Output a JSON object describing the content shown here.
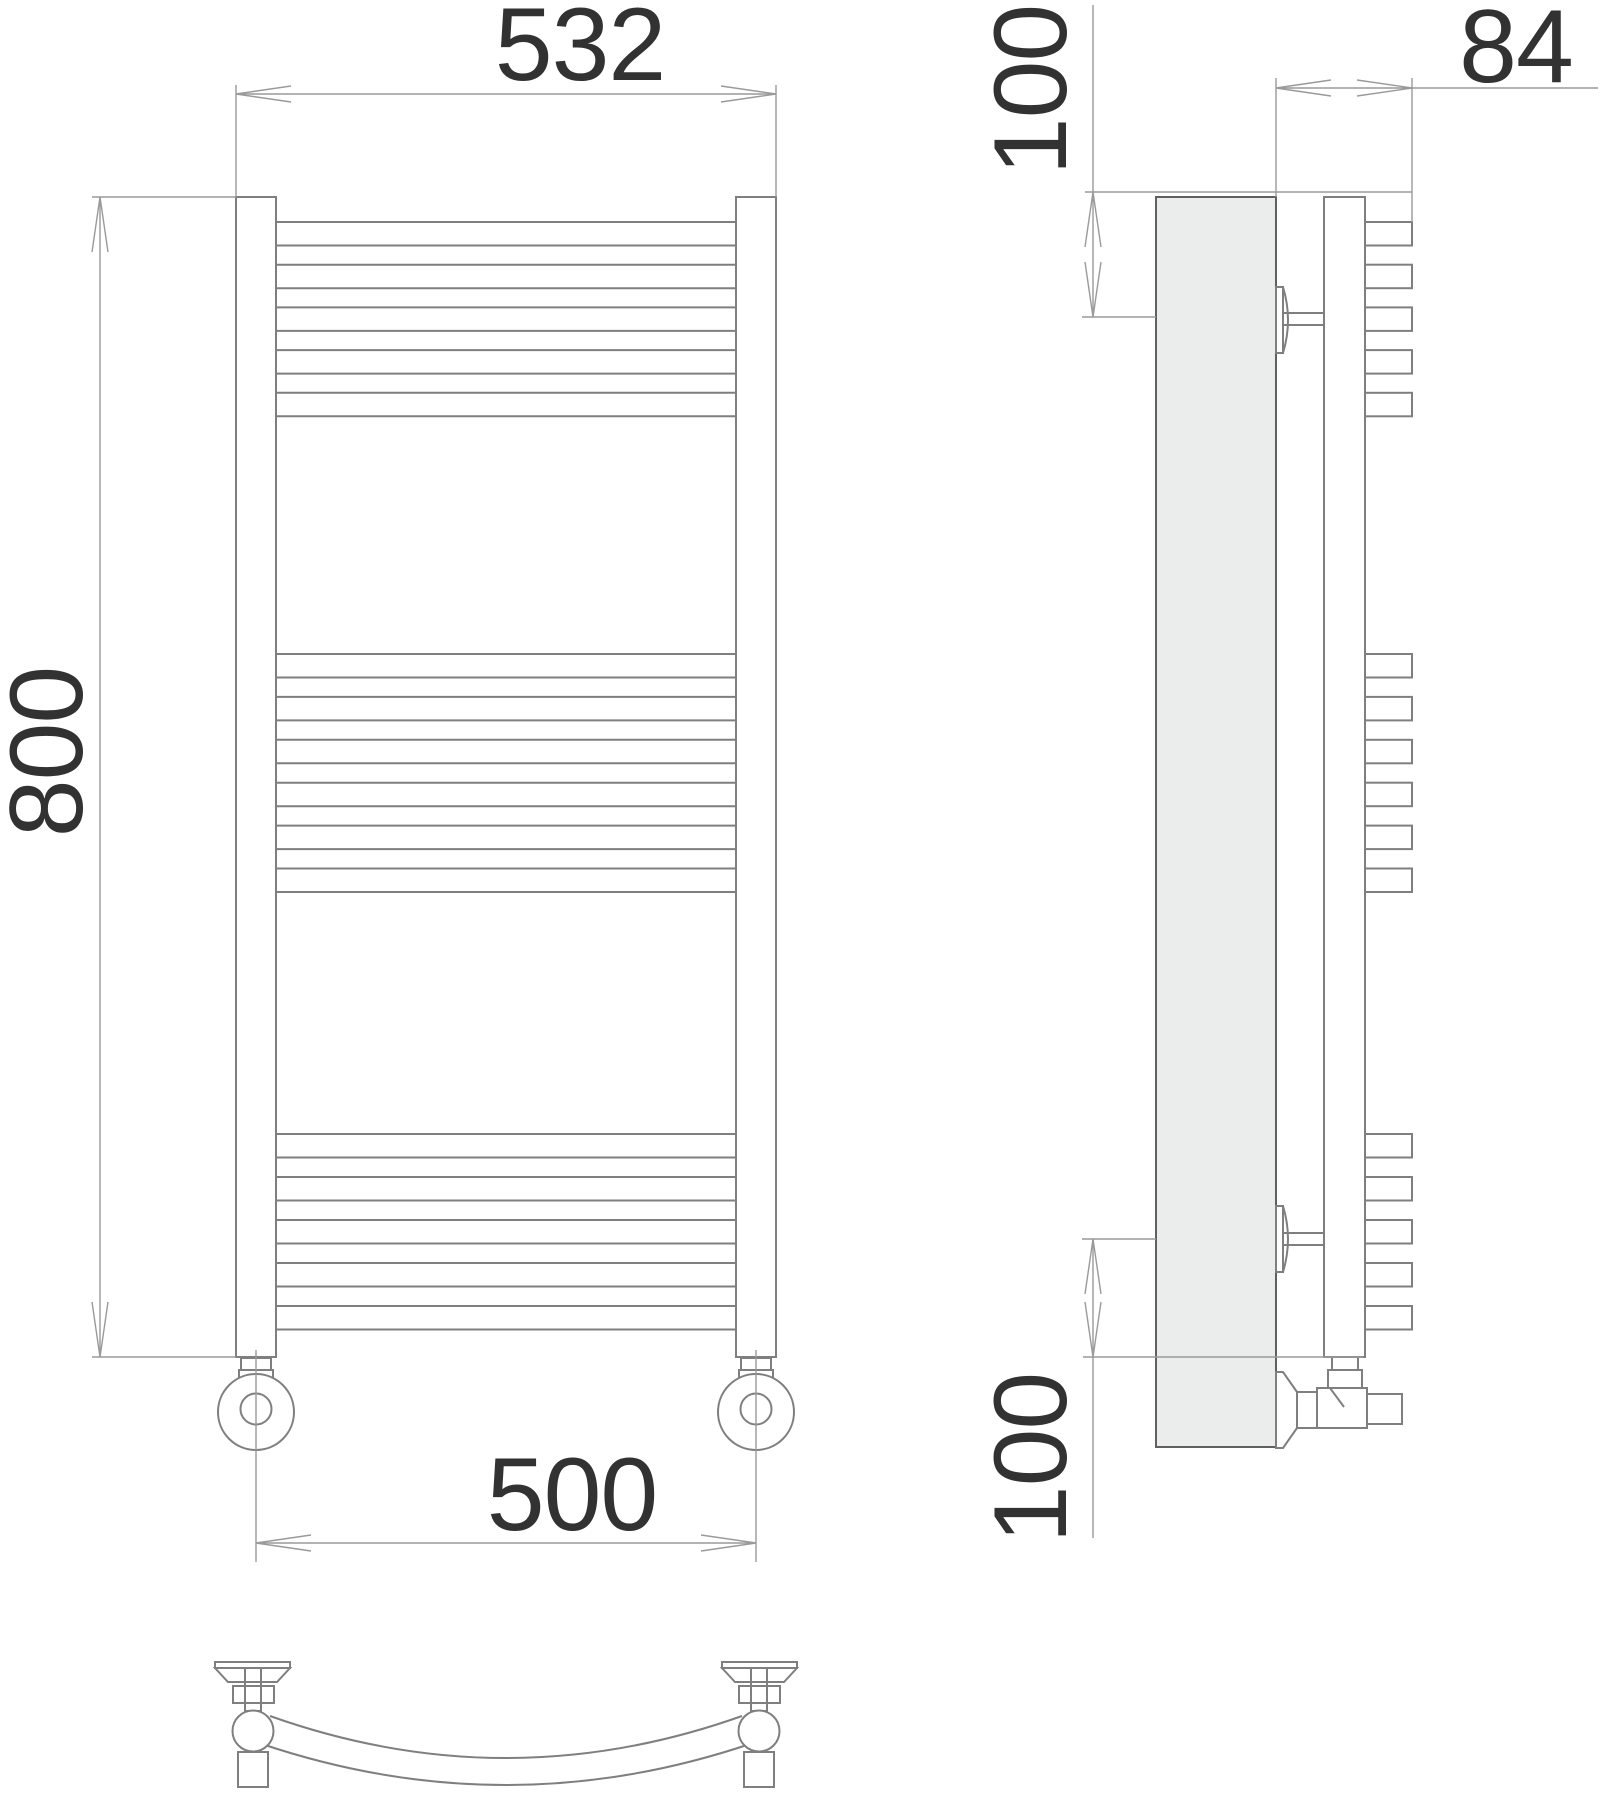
{
  "drawing": {
    "dimensions": {
      "overall_width_mm": "532",
      "overall_height_mm": "800",
      "connection_spacing_mm": "500",
      "wall_distance_mm": "84",
      "top_bracket_offset_mm": "100",
      "bottom_bracket_offset_mm": "100"
    },
    "structure": {
      "rung_groups": [
        5,
        6,
        5
      ],
      "rung_total": 16,
      "views": [
        "front",
        "side",
        "bottom"
      ]
    }
  }
}
